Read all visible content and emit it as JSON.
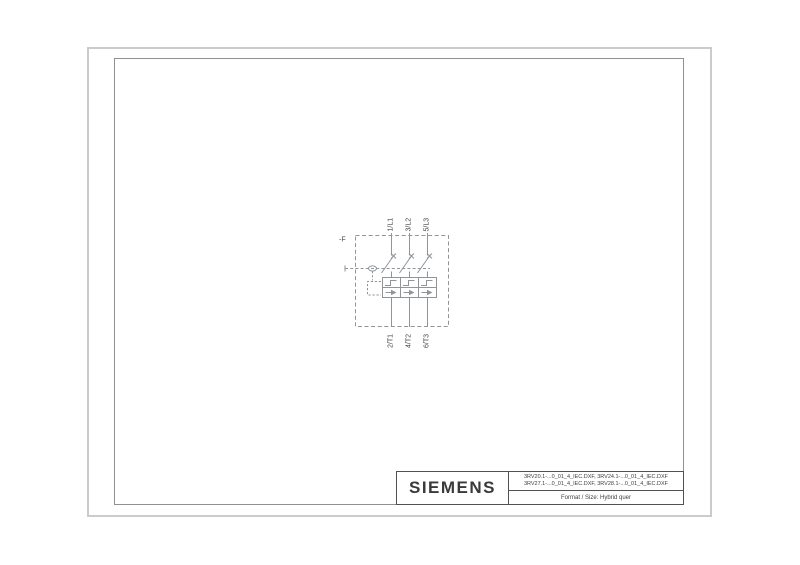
{
  "colors": {
    "outer_frame_color": "#c9ccce",
    "inner_frame_color": "#8e9296",
    "title_border_color": "#515151",
    "brand_text_color": "#3a3a3a",
    "schematic_line_color": "#8f959a",
    "schematic_text_color": "#474747"
  },
  "schematic": {
    "device_label": "-F",
    "top_terminals": [
      "1/L1",
      "3/L2",
      "5/L3"
    ],
    "bottom_terminals": [
      "2/T1",
      "4/T2",
      "6/T3"
    ]
  },
  "title_block": {
    "brand": "SIEMENS",
    "filenames": [
      "3RV20.1-...0_01_4_IEC.DXF, 3RV24.1-...0_01_4_IEC.DXF",
      "3RV27.1-...0_01_4_IEC.DXF, 3RV28.1-...0_01_4_IEC.DXF"
    ],
    "format_label": "Format / Size: Hybrid quer"
  }
}
